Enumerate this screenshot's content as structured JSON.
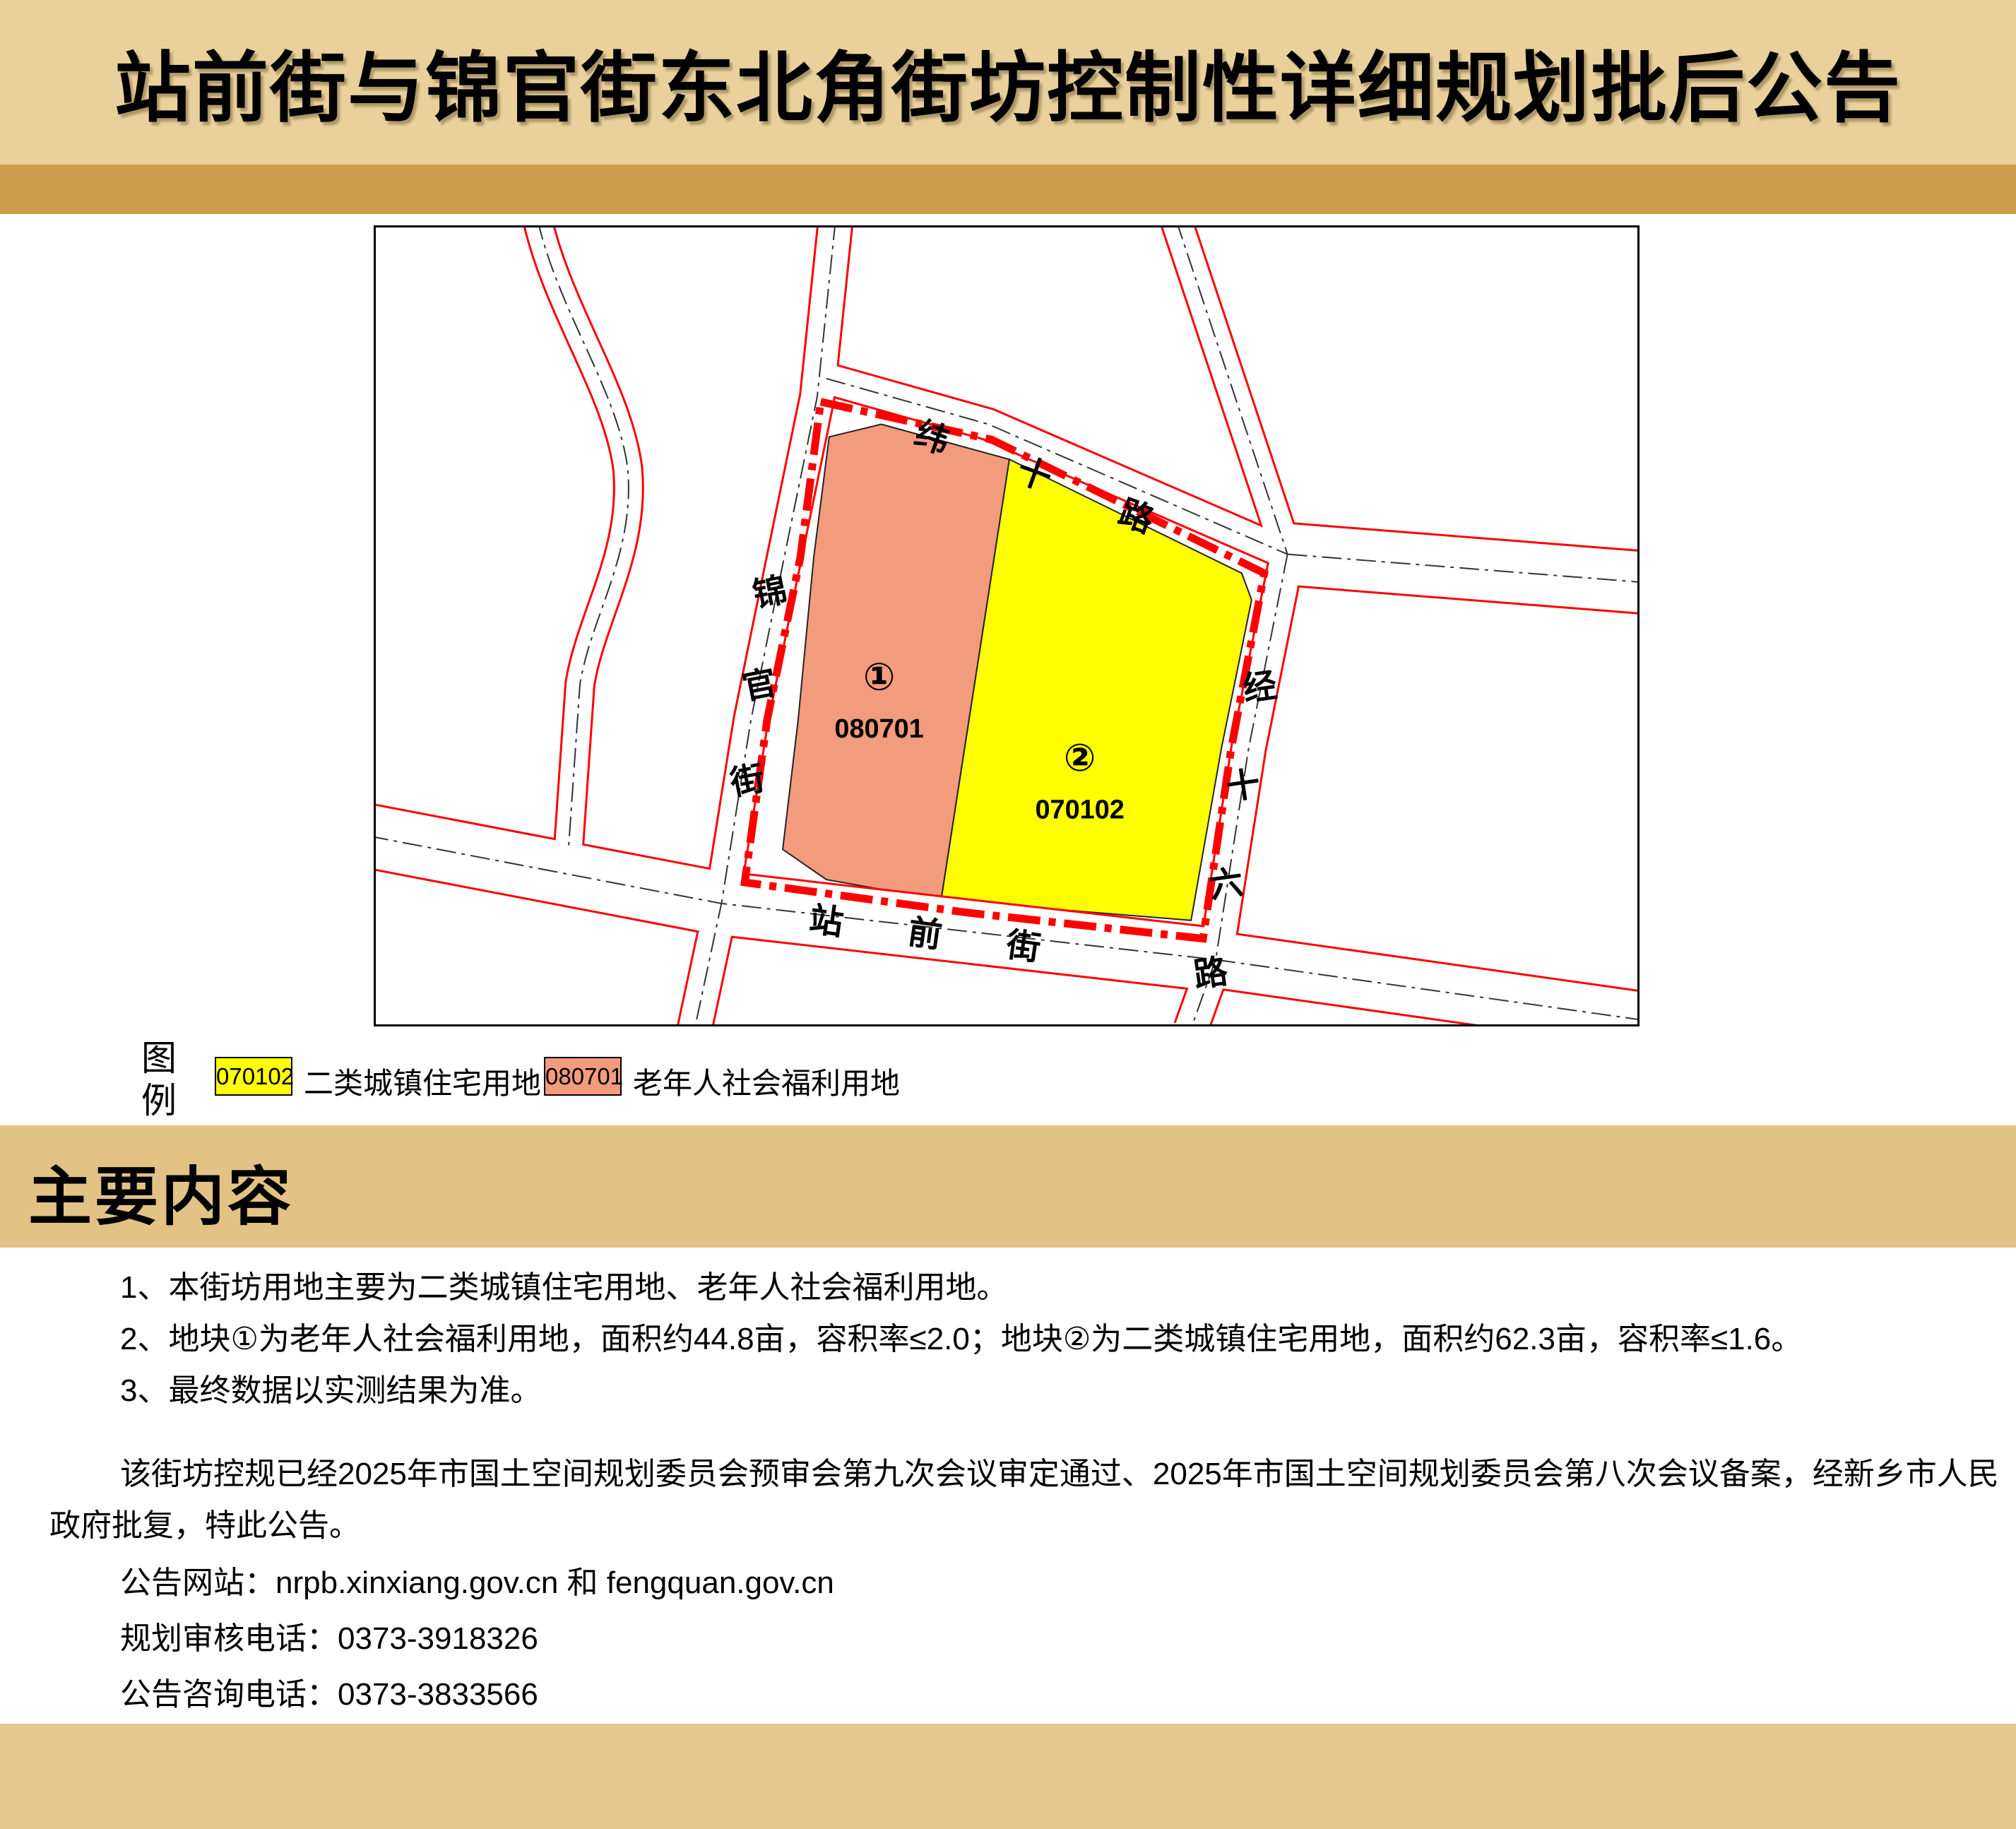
{
  "page_title": "站前街与锦官街东北角街坊控制性详细规划批后公告",
  "map": {
    "road_names": {
      "weishi": "纬十路",
      "jinguan": "锦官街",
      "jingshiliu": "经十六路",
      "zhanqian": "站前街"
    },
    "parcels": [
      {
        "index": "①",
        "code": "080701",
        "use": "老年人社会福利用地",
        "color": "#F29B7D"
      },
      {
        "index": "②",
        "code": "070102",
        "use": "二类城镇住宅用地",
        "color": "#FFFF00"
      }
    ],
    "boundary_color": "#FF0000",
    "road_line_color": "#FF0000",
    "centerline_color": "#333333"
  },
  "legend": {
    "heading": "图例",
    "items": [
      {
        "code": "070102",
        "label": "二类城镇住宅用地",
        "color": "#FFFF00"
      },
      {
        "code": "080701",
        "label": "老年人社会福利用地",
        "color": "#F29B7D"
      }
    ]
  },
  "section_heading": "主要内容",
  "content": {
    "items": [
      "1、本街坊用地主要为二类城镇住宅用地、老年人社会福利用地。",
      "2、地块①为老年人社会福利用地，面积约44.8亩，容积率≤2.0；地块②为二类城镇住宅用地，面积约62.3亩，容积率≤1.6。",
      "3、最终数据以实测结果为准。"
    ],
    "paragraph": "该街坊控规已经2025年市国土空间规划委员会预审会第九次会议审定通过、2025年市国土空间规划委员会第八次会议备案，经新乡市人民政府批复，特此公告。",
    "website_line": "公告网站：nrpb.xinxiang.gov.cn 和 fengquan.gov.cn",
    "review_phone_line": "规划审核电话：0373-3918326",
    "inquiry_phone_line": "公告咨询电话：0373-3833566"
  },
  "colors": {
    "header_band": "#EAD19C",
    "gold_strip": "#CB9D4A",
    "section_band": "#E2C285",
    "footer_band": "#E4C88E"
  }
}
